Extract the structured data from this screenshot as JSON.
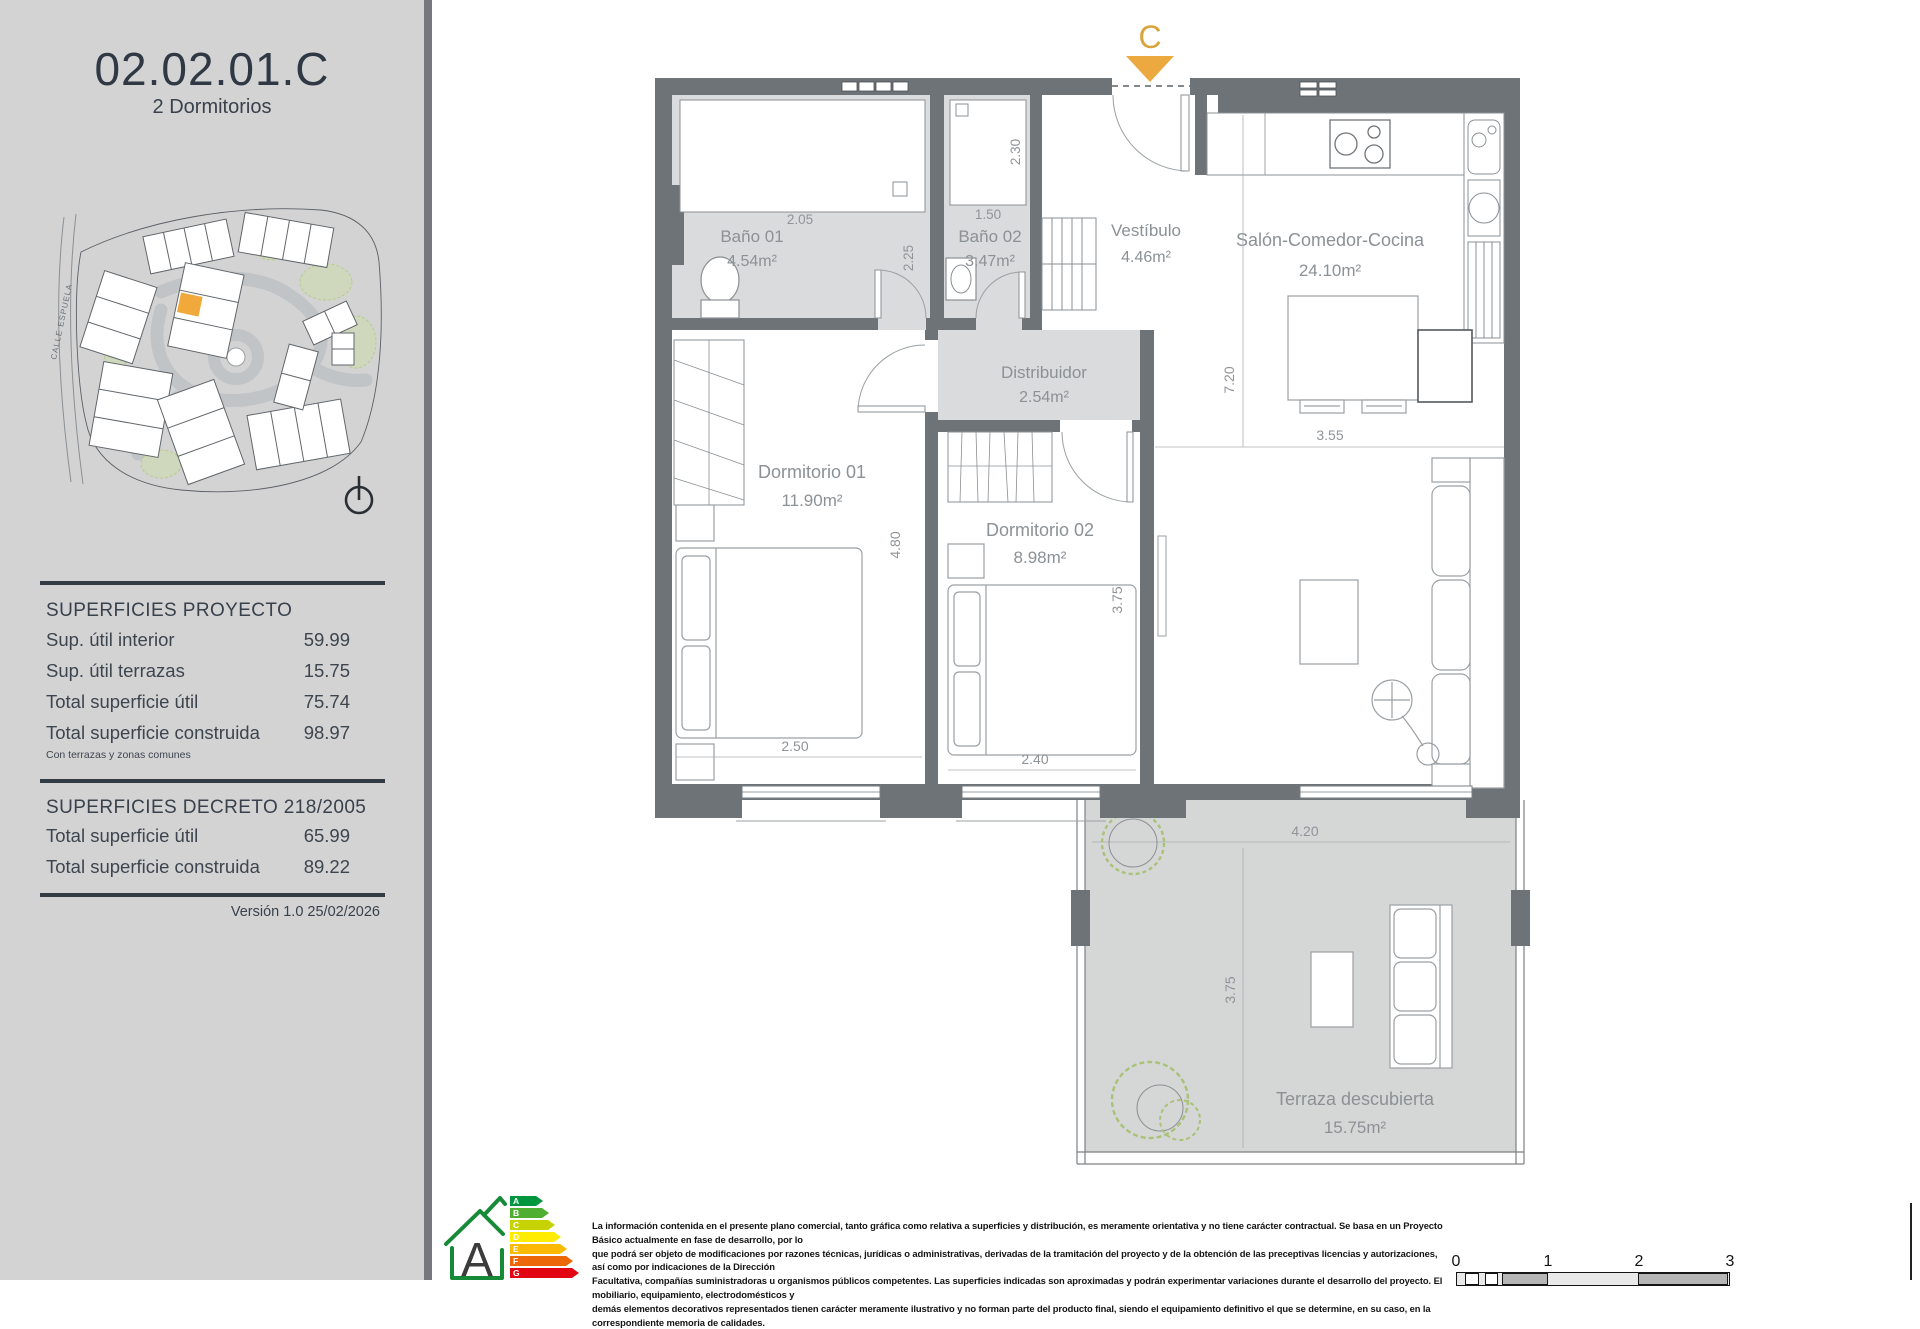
{
  "colors": {
    "accent_gold": "#EBA93F",
    "wall_gray": "#6E7378",
    "floor_gray": "#D8D9DA",
    "sidebar_gray": "#D3D3D4",
    "energy_green": "#178A38"
  },
  "sidebar": {
    "unit_code": "02.02.01.C",
    "unit_type": "2 Dormitorios",
    "street_label": "CALLE ESPUELA",
    "superficies_proyecto": {
      "title": "SUPERFICIES PROYECTO",
      "rows": [
        {
          "label": "Sup. útil interior",
          "value": "59.99"
        },
        {
          "label": "Sup. útil terrazas",
          "value": "15.75"
        },
        {
          "label": "Total superficie útil",
          "value": "75.74"
        },
        {
          "label": "Total superficie construida",
          "value": "98.97"
        }
      ],
      "footnote": "Con terrazas y zonas comunes"
    },
    "superficies_decreto": {
      "title": "SUPERFICIES DECRETO 218/2005",
      "rows": [
        {
          "label": "Total superficie útil",
          "value": "65.99"
        },
        {
          "label": "Total superficie construida",
          "value": "89.22"
        }
      ]
    },
    "version": "Versión 1.0 25/02/2026"
  },
  "plan": {
    "section_marker": "C",
    "rooms": [
      {
        "name": "Baño 01",
        "area": "4.54m²"
      },
      {
        "name": "Baño 02",
        "area": "3.47m²"
      },
      {
        "name": "Vestíbulo",
        "area": "4.46m²"
      },
      {
        "name": "Salón-Comedor-Cocina",
        "area": "24.10m²"
      },
      {
        "name": "Distribuidor",
        "area": "2.54m²"
      },
      {
        "name": "Dormitorio 01",
        "area": "11.90m²"
      },
      {
        "name": "Dormitorio 02",
        "area": "8.98m²"
      },
      {
        "name": "Terraza descubierta",
        "area": "15.75m²"
      }
    ],
    "dims": {
      "bano01_width": "2.05",
      "bano01_depth": "2.25",
      "bano02_width": "1.50",
      "bano02_depth": "2.30",
      "salon_height": "7.20",
      "salon_width": "3.55",
      "dorm01_height": "4.80",
      "dorm01_width": "2.50",
      "dorm02_width": "2.40",
      "dorm02_height": "3.75",
      "terraza_width": "4.20",
      "terraza_height": "3.75"
    }
  },
  "footer": {
    "energy": {
      "rating": "A",
      "levels": [
        "A",
        "B",
        "C",
        "D",
        "E",
        "F",
        "G"
      ]
    },
    "disclaimer_lines": [
      "La información contenida en el presente plano comercial, tanto gráfica como relativa a superficies y distribución, es meramente orientativa y no tiene carácter contractual. Se basa en un Proyecto Básico actualmente en fase de desarrollo, por lo",
      "que podrá ser objeto de modificaciones por razones técnicas, jurídicas o administrativas, derivadas de la tramitación del proyecto y de la obtención de las preceptivas licencias y autorizaciones, así como por indicaciones de la Dirección",
      "Facultativa, compañías suministradoras u organismos públicos competentes. Las superficies indicadas son aproximadas y podrán experimentar variaciones durante el desarrollo del proyecto. El mobiliario, equipamiento, electrodomésticos y",
      "demás elementos decorativos representados tienen carácter meramente ilustrativo y no forman parte del producto final, siendo el equipamiento definitivo el que se determine, en su caso, en la correspondiente memoria de calidades."
    ],
    "scale_ticks": [
      "0",
      "1",
      "2",
      "3"
    ]
  }
}
